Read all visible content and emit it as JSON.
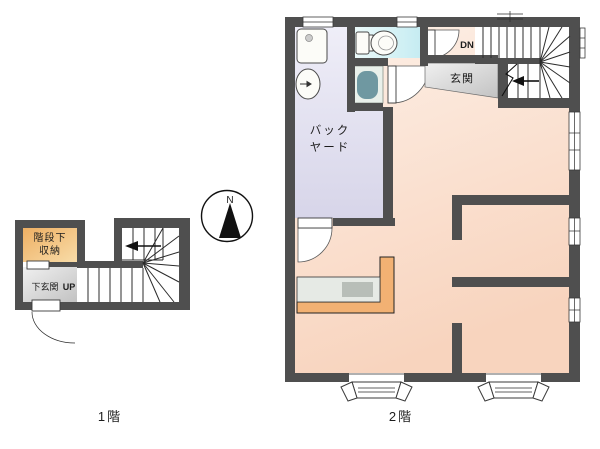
{
  "floor1": {
    "caption": "1階",
    "storage_label": [
      "階段下",
      "収納"
    ],
    "entrance_label": "下玄関",
    "up_label": "UP"
  },
  "floor2": {
    "caption": "2階",
    "backyard_label": [
      "バック",
      "ヤード"
    ],
    "entrance_label": "玄関",
    "down_label": "DN"
  },
  "compass": {
    "north_label": "N"
  },
  "colors": {
    "wall": "#4f4f4f",
    "peach_light": "#fdf0e7",
    "peach_dark": "#f8d4be",
    "lavender_light": "#efeef8",
    "lavender_dark": "#d7d5e9",
    "cyan_light": "#ebfafa",
    "cyan_dark": "#c6ecf2",
    "storage_light": "#f8dca8",
    "storage_dark": "#eeaf63",
    "gray_light": "#f0f0f0",
    "gray_dark": "#c2c2c2",
    "counter_orange": "#f2b173",
    "counter_gray": "#e6eae5",
    "sink_gray": "#b8beb8",
    "pan_bg": "#e9f0ea",
    "washer_teal": "#6f98a1"
  }
}
